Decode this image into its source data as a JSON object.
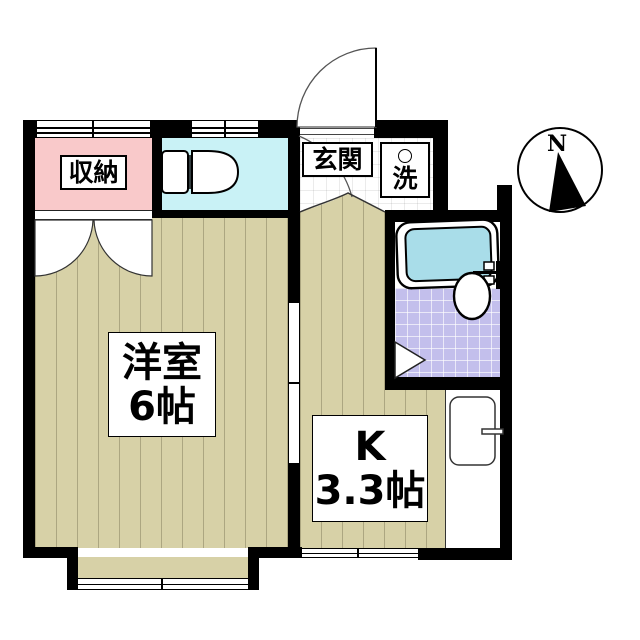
{
  "plan": {
    "type": "apartment-floor-plan-1K",
    "rooms": {
      "storage": {
        "label": "収納"
      },
      "entrance": {
        "label": "玄関"
      },
      "laundry": {
        "label": "洗"
      },
      "western_room": {
        "label": "洋室",
        "size": "6帖"
      },
      "kitchen": {
        "label": "K",
        "size": "3.3帖"
      }
    },
    "compass": {
      "north_label": "N"
    },
    "colors": {
      "wall": "#000000",
      "storage_fill": "#f9c9ca",
      "toilet_fill": "#c9f2f6",
      "bathtub_fill": "#a9dde9",
      "bath_tile_fill": "#c3bfec",
      "wood_floor_fill": "#d7d1a7",
      "entrance_tile_fill": "#ffffff"
    }
  }
}
